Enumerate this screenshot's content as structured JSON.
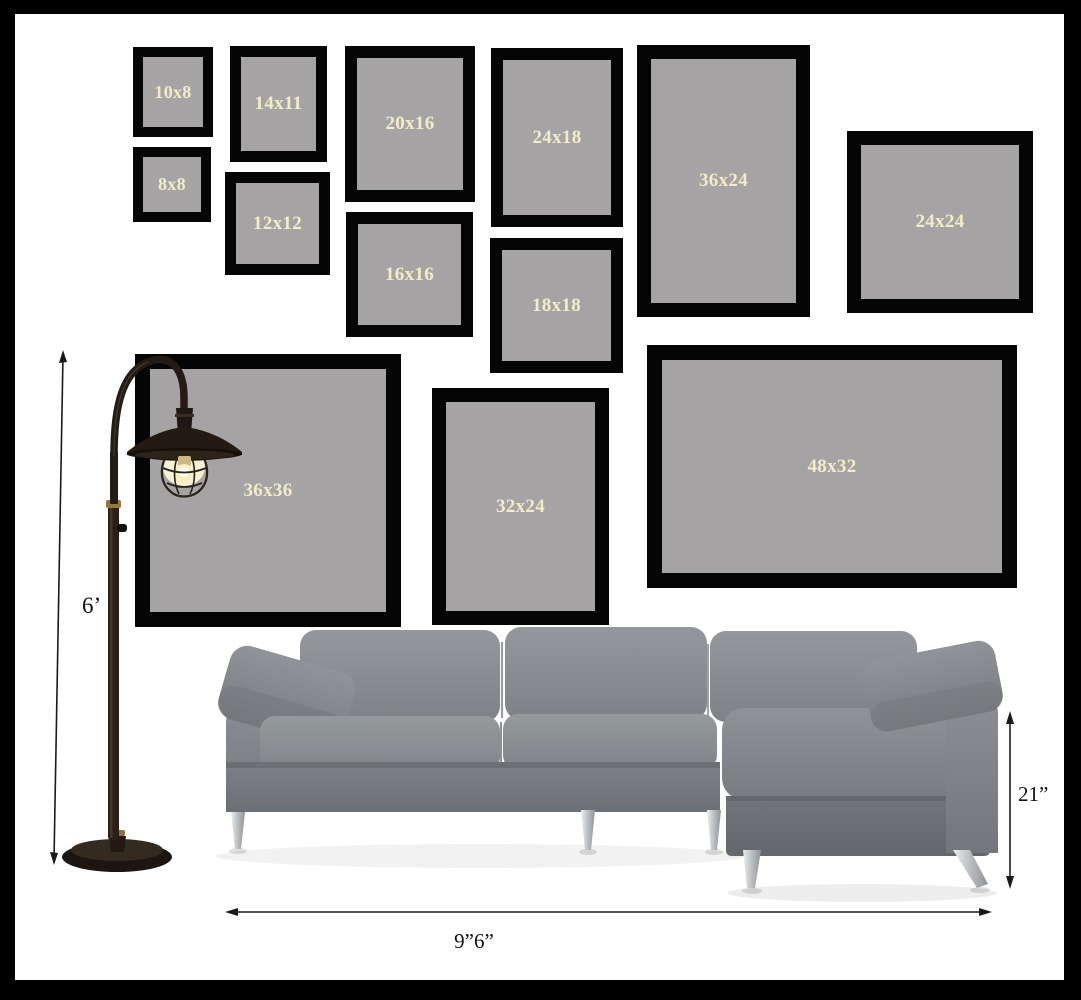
{
  "frames": [
    {
      "label": "10x8"
    },
    {
      "label": "14x11"
    },
    {
      "label": "20x16"
    },
    {
      "label": "24x18"
    },
    {
      "label": "36x24"
    },
    {
      "label": "24x24"
    },
    {
      "label": "8x8"
    },
    {
      "label": "12x12"
    },
    {
      "label": "16x16"
    },
    {
      "label": "18x18"
    },
    {
      "label": "36x36"
    },
    {
      "label": "32x24"
    },
    {
      "label": "48x32"
    }
  ],
  "annotations": {
    "lamp_height": "6’",
    "sofa_height": "21”",
    "sofa_width": "9”6”"
  },
  "colors": {
    "outer_border": "#000000",
    "background": "#ffffff",
    "frame_border": "#050505",
    "frame_mat": "#a6a3a4",
    "frame_label": "#f2edc6",
    "sofa_gray": "#888c90",
    "lamp_dark": "#241b15",
    "dimension_line": "#1a1a1a"
  }
}
